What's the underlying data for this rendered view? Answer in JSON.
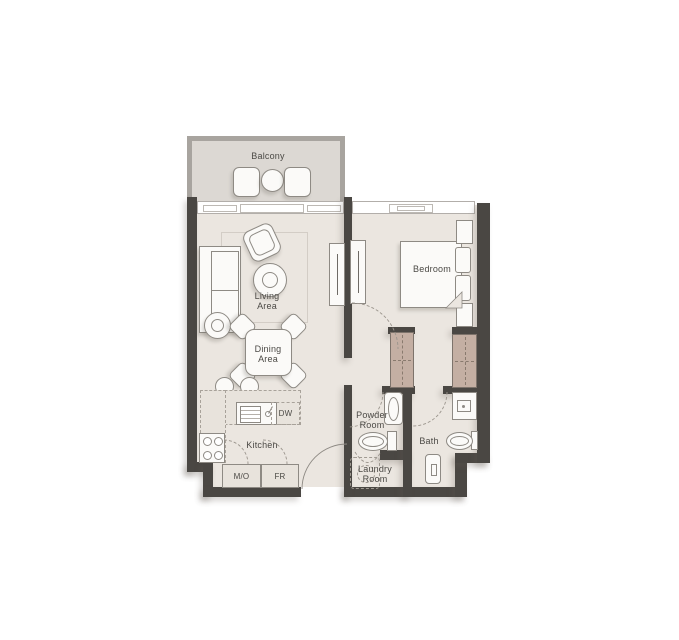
{
  "plan": {
    "rooms": {
      "balcony": {
        "label": "Balcony"
      },
      "living_area": {
        "line1": "Living",
        "line2": "Area"
      },
      "dining_area": {
        "line1": "Dining",
        "line2": "Area"
      },
      "bedroom": {
        "label": "Bedroom"
      },
      "kitchen": {
        "label": "Kitchen"
      },
      "powder_room": {
        "line1": "Powder",
        "line2": "Room"
      },
      "bath": {
        "label": "Bath"
      },
      "laundry_room": {
        "line1": "Laundry",
        "line2": "Room"
      }
    },
    "appliances": {
      "dishwasher_label": "DW",
      "microwave_oven_label": "M/O",
      "fridge_label": "FR"
    },
    "colors": {
      "wall": "#4a4743",
      "floor": "#ebe6e0",
      "balcony_floor": "#dcd8d3",
      "balcony_wall": "#a8a49f",
      "wardrobe": "#c4afa3",
      "furniture_fill": "#fbfaf8",
      "furniture_line": "#8e8a84",
      "counter_fill": "#e8e3dc",
      "text": "#4b4945",
      "background": "#ffffff"
    }
  }
}
